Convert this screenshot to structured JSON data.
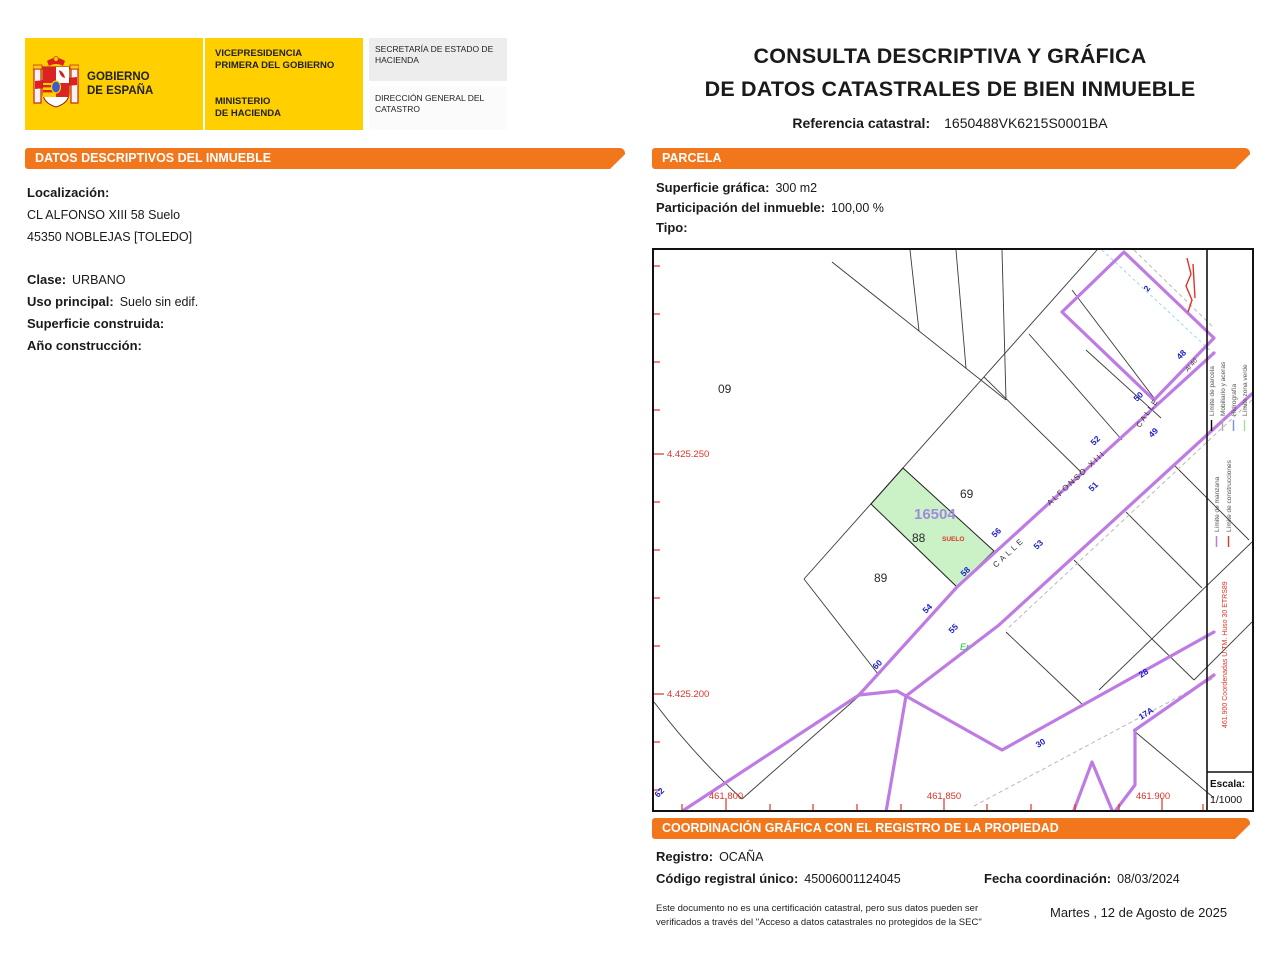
{
  "header": {
    "logo": {
      "gobierno_line1": "GOBIERNO",
      "gobierno_line2": "DE ESPAÑA",
      "vicepresidencia_line1": "VICEPRESIDENCIA",
      "vicepresidencia_line2": "PRIMERA DEL GOBIERNO",
      "ministerio_line1": "MINISTERIO",
      "ministerio_line2": "DE HACIENDA",
      "secretaria": "SECRETARÍA DE ESTADO DE HACIENDA",
      "direccion": "DIRECCIÓN GENERAL DEL CATASTRO"
    },
    "title_line1": "CONSULTA DESCRIPTIVA Y GRÁFICA",
    "title_line2": "DE DATOS CATASTRALES DE BIEN INMUEBLE",
    "ref_label": "Referencia catastral:",
    "ref_value": "1650488VK6215S0001BA"
  },
  "datos": {
    "section_title": "DATOS DESCRIPTIVOS DEL INMUEBLE",
    "localizacion_label": "Localización:",
    "address_line1": "CL ALFONSO XIII 58 Suelo",
    "address_line2": "45350 NOBLEJAS [TOLEDO]",
    "clase_label": "Clase:",
    "clase_value": "URBANO",
    "uso_label": "Uso principal:",
    "uso_value": "Suelo sin edif.",
    "superficie_label": "Superficie construida:",
    "superficie_value": "",
    "anio_label": "Año construcción:",
    "anio_value": ""
  },
  "parcela": {
    "section_title": "PARCELA",
    "superficie_label": "Superficie gráfica:",
    "superficie_value": "300 m2",
    "participacion_label": "Participación del inmueble:",
    "participacion_value": "100,00 %",
    "tipo_label": "Tipo:",
    "tipo_value": ""
  },
  "map": {
    "parcel_numbers": [
      "09",
      "69",
      "88",
      "89"
    ],
    "manzana_number": "16504",
    "use_label": "SUELO",
    "cultivo_label": "Er",
    "misc_label": "Al 40",
    "street_main_1": "CALLE",
    "street_main_2": "ALFONSO XIII",
    "street_secondary": "CALLE",
    "house_numbers": [
      "60",
      "54",
      "58",
      "56",
      "52",
      "50",
      "48",
      "55",
      "53",
      "51",
      "49",
      "30",
      "28",
      "17A",
      "62",
      "2"
    ],
    "coord_labels_left": [
      "4.425.250",
      "4.425.200"
    ],
    "coord_labels_bottom": [
      "461.800",
      "461.850",
      "461.900"
    ],
    "legend": {
      "items": [
        "Límite de parcela",
        "Mobiliario y aceras",
        "Hidrografía",
        "Límite zona verde",
        "Límite de manzana",
        "Límite de construcciones"
      ],
      "coords_note": "461.900 Coordenadas U.TM. Huso 30 ETRS89",
      "escala_label": "Escala:",
      "escala_value": "1/1000"
    },
    "colors": {
      "parcel_highlight": "#CBF2C7",
      "manzana_line": "#BE7BE4",
      "house_number_blue": "#1d1dc8",
      "coordinate_red": "#E03226",
      "accent_orange": "#F2761B"
    }
  },
  "coordinacion": {
    "section_title": "COORDINACIÓN GRÁFICA CON EL REGISTRO DE LA PROPIEDAD",
    "registro_label": "Registro:",
    "registro_value": "OCAÑA",
    "codigo_label": "Código registral único:",
    "codigo_value": "45006001124045",
    "fecha_label": "Fecha coordinación:",
    "fecha_value": "08/03/2024",
    "disclaimer_line1": "Este documento no es una certificación catastral, pero sus datos pueden ser",
    "disclaimer_line2": "verificados a través del \"Acceso a datos catastrales no protegidos de la SEC\"",
    "date": "Martes , 12 de Agosto de 2025"
  }
}
